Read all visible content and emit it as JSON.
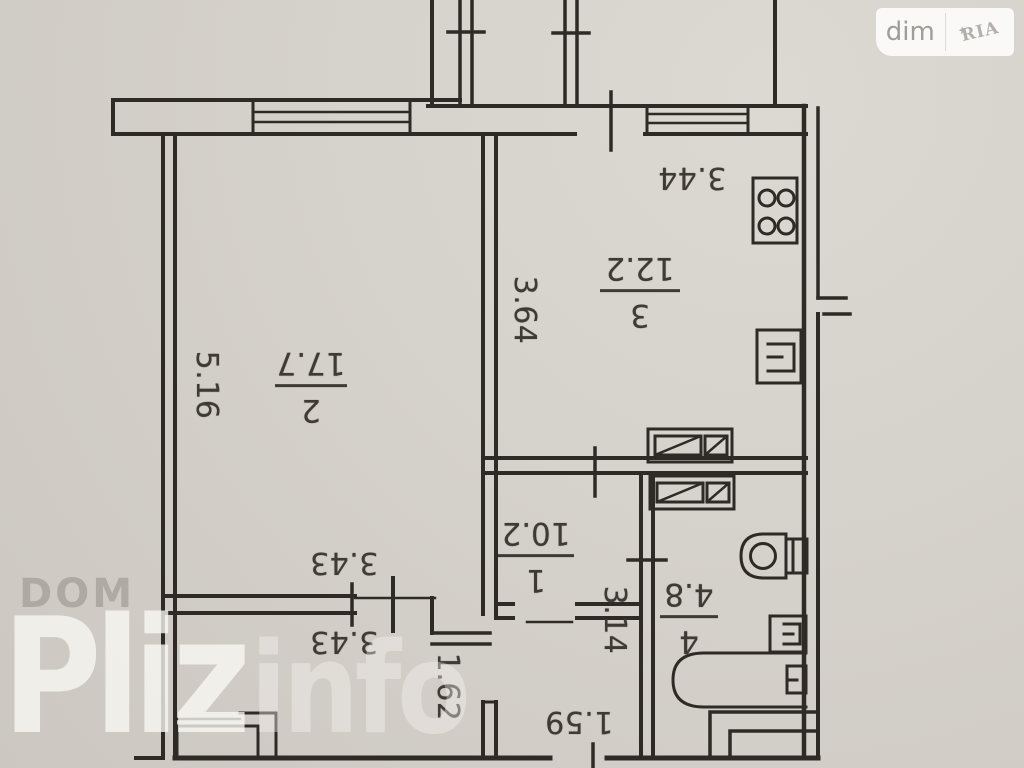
{
  "watermark_top_right": {
    "dim_label": "dim",
    "ria_label": "RIA",
    "star": "★"
  },
  "watermark_bottom_left": {
    "dom": "DOM",
    "pliz": "Pliz",
    "info": "info"
  },
  "plan": {
    "rooms": [
      {
        "number": "3",
        "area": "12.2"
      },
      {
        "number": "2",
        "area": "17.7"
      },
      {
        "number": "1",
        "area": "10.2"
      },
      {
        "number": "4",
        "area": "4.8"
      }
    ],
    "dimensions": {
      "kitchen_width": "3.44",
      "kitchen_depth": "3.64",
      "living_depth": "5.16",
      "living_width": "3.43",
      "loggia_width": "3.43",
      "hall_height": "1.62",
      "corridor_depth": "3.14",
      "entry_width": "1.59"
    }
  }
}
